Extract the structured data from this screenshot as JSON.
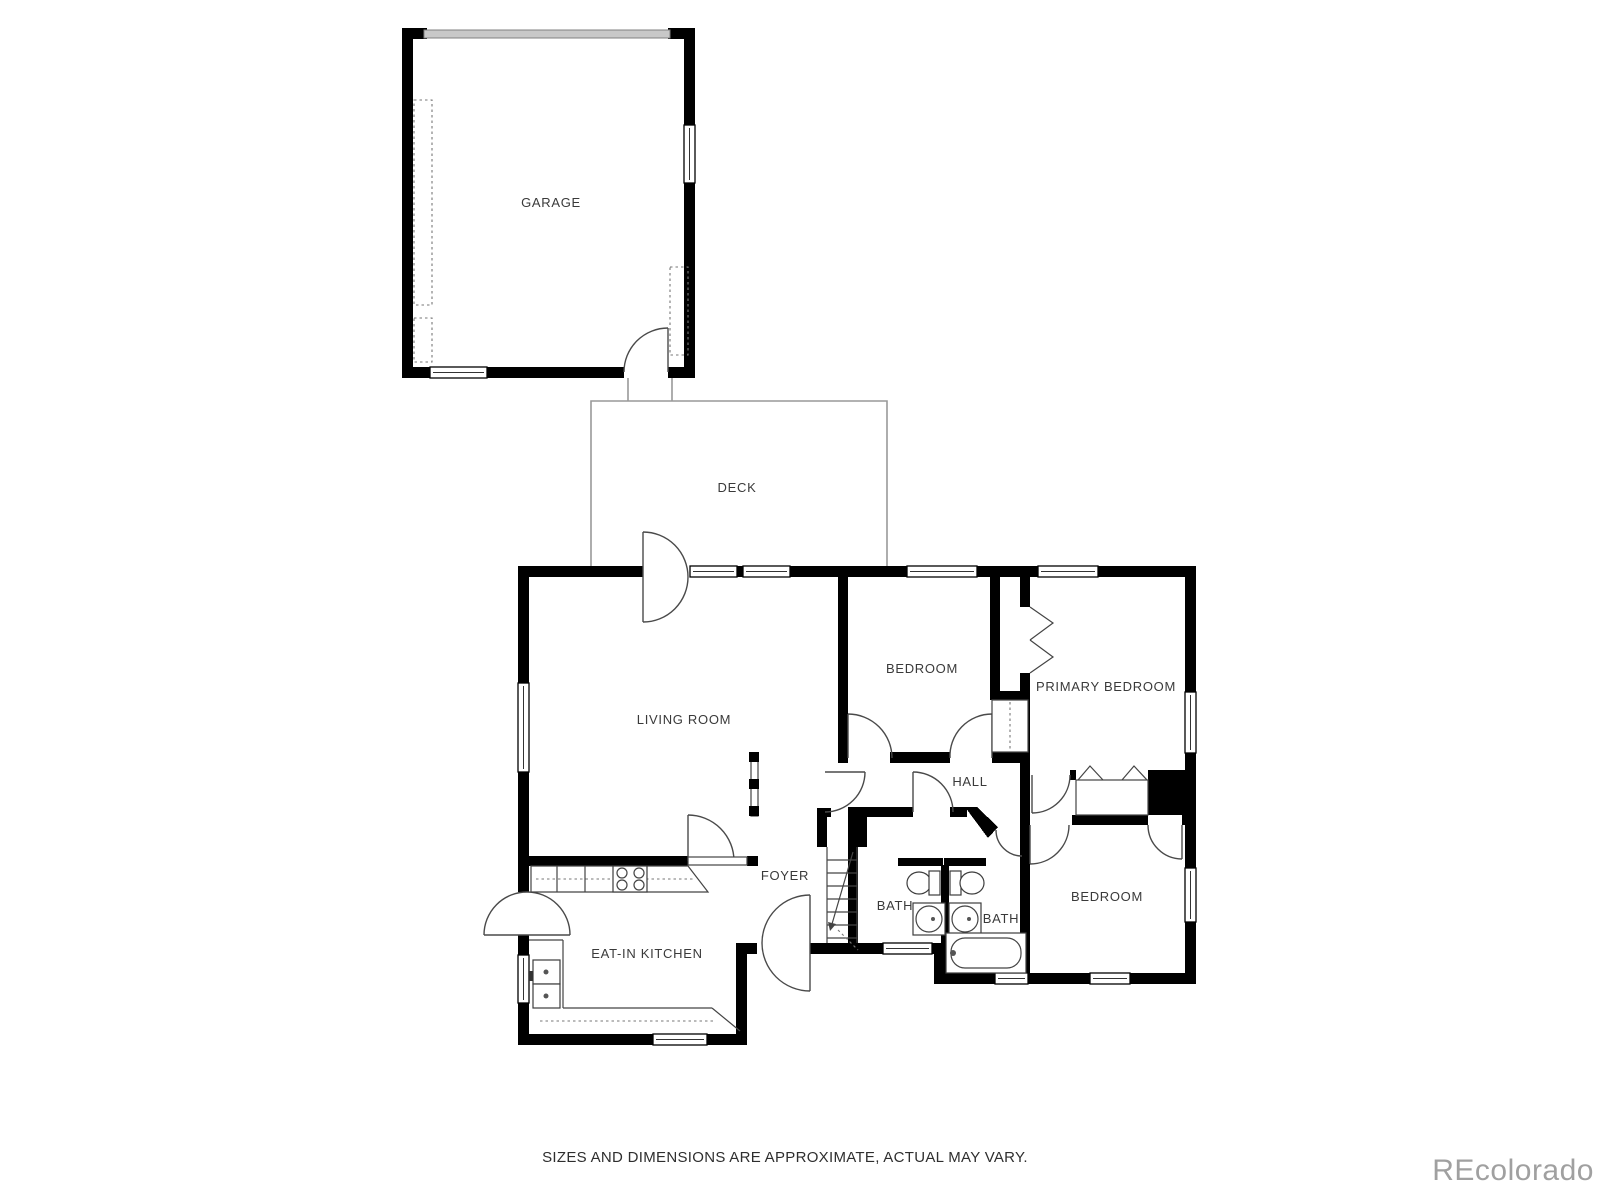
{
  "page": {
    "background": "#ffffff"
  },
  "floor_plan": {
    "wall_color": "#000000",
    "thin_line_color": "#444444",
    "deck_outline_color": "#999999",
    "garage_door_color": "#c8c8c8",
    "label_color": "#3a3a3a",
    "rooms": [
      {
        "id": "garage",
        "label": "GARAGE"
      },
      {
        "id": "deck",
        "label": "DECK"
      },
      {
        "id": "living-room",
        "label": "LIVING ROOM"
      },
      {
        "id": "bedroom-upper",
        "label": "BEDROOM"
      },
      {
        "id": "primary-bedroom",
        "label": "PRIMARY BEDROOM"
      },
      {
        "id": "hall",
        "label": "HALL"
      },
      {
        "id": "foyer",
        "label": "FOYER"
      },
      {
        "id": "eat-in-kitchen",
        "label": "EAT-IN KITCHEN"
      },
      {
        "id": "bath-left",
        "label": "BATH"
      },
      {
        "id": "bath-right",
        "label": "BATH"
      },
      {
        "id": "bedroom-lower",
        "label": "BEDROOM"
      }
    ]
  },
  "footer": {
    "disclaimer": "SIZES AND DIMENSIONS ARE APPROXIMATE, ACTUAL MAY VARY."
  },
  "watermark": {
    "text": "REcolorado",
    "color": "#a0a0a0"
  }
}
